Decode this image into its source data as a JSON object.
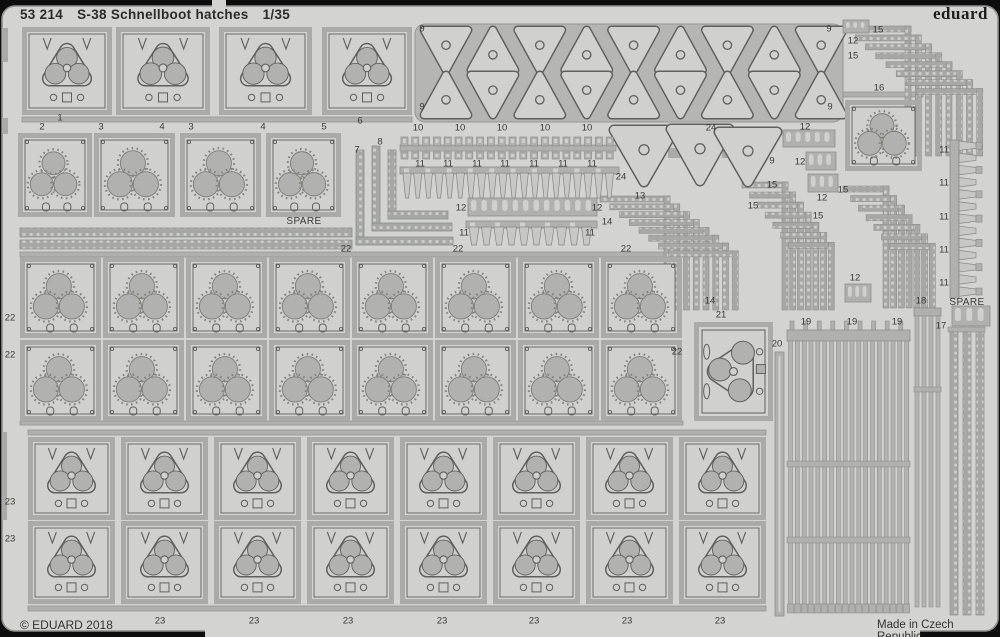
{
  "header": {
    "catalog": "53 214",
    "title": "S-38 Schnellboot hatches",
    "scale": "1/35",
    "brand": "eduard"
  },
  "footer": {
    "copyright": "© EDUARD 2018",
    "made_in": "Made in Czech Republic"
  },
  "colors": {
    "background": "#0d0d0d",
    "sheet": "#d3d4d1",
    "sheet_edge": "#8f908d",
    "frame": "#aaaba8",
    "rail": "#b0b1ae",
    "plate": "#d0d1ce",
    "outline": "#5f605c",
    "circle_fill": "#b1b2af",
    "tooth": "#c7c8c5",
    "perf_base": "#a7a8a5",
    "perf_dot": "#cdcecb",
    "text": "#3a3b36"
  },
  "labels": [
    {
      "t": "1",
      "x": 60,
      "y": 118
    },
    {
      "t": "2",
      "x": 42,
      "y": 127
    },
    {
      "t": "3",
      "x": 101,
      "y": 127
    },
    {
      "t": "4",
      "x": 162,
      "y": 127
    },
    {
      "t": "3",
      "x": 191,
      "y": 127
    },
    {
      "t": "4",
      "x": 263,
      "y": 127
    },
    {
      "t": "5",
      "x": 324,
      "y": 127
    },
    {
      "t": "6",
      "x": 360,
      "y": 121
    },
    {
      "t": "9",
      "x": 422,
      "y": 29
    },
    {
      "t": "9",
      "x": 829,
      "y": 29
    },
    {
      "t": "9",
      "x": 422,
      "y": 107
    },
    {
      "t": "9",
      "x": 830,
      "y": 107
    },
    {
      "t": "10",
      "x": 418,
      "y": 128
    },
    {
      "t": "10",
      "x": 460,
      "y": 128
    },
    {
      "t": "10",
      "x": 502,
      "y": 128
    },
    {
      "t": "10",
      "x": 545,
      "y": 128
    },
    {
      "t": "10",
      "x": 587,
      "y": 128
    },
    {
      "t": "7",
      "x": 357,
      "y": 150
    },
    {
      "t": "8",
      "x": 380,
      "y": 142
    },
    {
      "t": "11",
      "x": 420,
      "y": 164
    },
    {
      "t": "11",
      "x": 448,
      "y": 164
    },
    {
      "t": "11",
      "x": 477,
      "y": 164
    },
    {
      "t": "11",
      "x": 505,
      "y": 164
    },
    {
      "t": "11",
      "x": 534,
      "y": 164
    },
    {
      "t": "11",
      "x": 563,
      "y": 164
    },
    {
      "t": "11",
      "x": 592,
      "y": 164
    },
    {
      "t": "12",
      "x": 461,
      "y": 208
    },
    {
      "t": "12",
      "x": 597,
      "y": 208
    },
    {
      "t": "11",
      "x": 464,
      "y": 233
    },
    {
      "t": "11",
      "x": 590,
      "y": 233
    },
    {
      "t": "24",
      "x": 711,
      "y": 128
    },
    {
      "t": "24",
      "x": 621,
      "y": 177
    },
    {
      "t": "9",
      "x": 772,
      "y": 161
    },
    {
      "t": "12",
      "x": 805,
      "y": 127
    },
    {
      "t": "12",
      "x": 800,
      "y": 162
    },
    {
      "t": "12",
      "x": 822,
      "y": 198
    },
    {
      "t": "12",
      "x": 853,
      "y": 41
    },
    {
      "t": "12",
      "x": 855,
      "y": 278
    },
    {
      "t": "15",
      "x": 878,
      "y": 30
    },
    {
      "t": "15",
      "x": 853,
      "y": 56
    },
    {
      "t": "16",
      "x": 879,
      "y": 88
    },
    {
      "t": "13",
      "x": 640,
      "y": 196
    },
    {
      "t": "14",
      "x": 607,
      "y": 222
    },
    {
      "t": "14",
      "x": 710,
      "y": 301
    },
    {
      "t": "15",
      "x": 772,
      "y": 185
    },
    {
      "t": "15",
      "x": 753,
      "y": 206
    },
    {
      "t": "15",
      "x": 843,
      "y": 190
    },
    {
      "t": "15",
      "x": 818,
      "y": 216
    },
    {
      "t": "11",
      "x": 944,
      "y": 150
    },
    {
      "t": "11",
      "x": 944,
      "y": 183
    },
    {
      "t": "11",
      "x": 944,
      "y": 217
    },
    {
      "t": "11",
      "x": 944,
      "y": 250
    },
    {
      "t": "11",
      "x": 944,
      "y": 283
    },
    {
      "t": "22",
      "x": 346,
      "y": 249
    },
    {
      "t": "22",
      "x": 458,
      "y": 249
    },
    {
      "t": "22",
      "x": 626,
      "y": 249
    },
    {
      "t": "22",
      "x": 10,
      "y": 318
    },
    {
      "t": "22",
      "x": 10,
      "y": 355
    },
    {
      "t": "22",
      "x": 677,
      "y": 352
    },
    {
      "t": "21",
      "x": 721,
      "y": 315
    },
    {
      "t": "20",
      "x": 777,
      "y": 344
    },
    {
      "t": "19",
      "x": 806,
      "y": 322
    },
    {
      "t": "19",
      "x": 852,
      "y": 322
    },
    {
      "t": "19",
      "x": 897,
      "y": 322
    },
    {
      "t": "18",
      "x": 921,
      "y": 301
    },
    {
      "t": "17",
      "x": 941,
      "y": 326
    },
    {
      "t": "23",
      "x": 10,
      "y": 502
    },
    {
      "t": "23",
      "x": 10,
      "y": 539
    },
    {
      "t": "23",
      "x": 160,
      "y": 621
    },
    {
      "t": "23",
      "x": 254,
      "y": 621
    },
    {
      "t": "23",
      "x": 348,
      "y": 621
    },
    {
      "t": "23",
      "x": 442,
      "y": 621
    },
    {
      "t": "23",
      "x": 534,
      "y": 621
    },
    {
      "t": "23",
      "x": 627,
      "y": 621
    },
    {
      "t": "23",
      "x": 720,
      "y": 621
    },
    {
      "t": "SPARE",
      "x": 304,
      "y": 222
    },
    {
      "t": "SPARE",
      "x": 967,
      "y": 303
    }
  ]
}
